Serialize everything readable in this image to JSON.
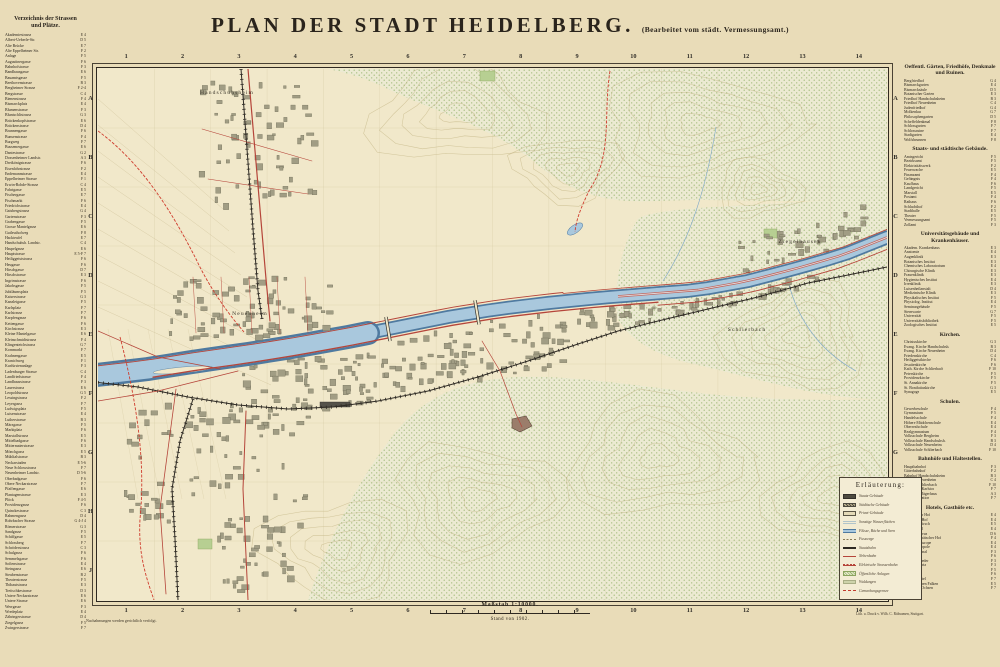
{
  "title": {
    "main": "PLAN DER STADT HEIDELBERG.",
    "sub": "(Bearbeitet vom städt. Vermessungsamt.)"
  },
  "footer": {
    "scale_label": "Maßstab 1:10000.",
    "stand": "Stand von 1902.",
    "note_left": "Nachahmungen werden gerichtlich verfolgt.",
    "note_right": "Lith. u. Druck v. Wilh. C. Rübsamen, Stuttgart."
  },
  "left_index": {
    "heading_line1": "Verzeichnis der Strassen",
    "heading_line2": "und Plätze.",
    "entries": [
      [
        "Akademiestrasse",
        "E 4"
      ],
      [
        "Albert-Ueberle-Str.",
        "D 5"
      ],
      [
        "Alte Brücke",
        "E 7"
      ],
      [
        "Alte Eppelheimer Str.",
        "F 2"
      ],
      [
        "Anlage",
        "F 5"
      ],
      [
        "Augustinergasse",
        "F 6"
      ],
      [
        "Bahnhofstrasse",
        "F 3"
      ],
      [
        "Bandhausgasse",
        "E 6"
      ],
      [
        "Bauamtsgasse",
        "F 5"
      ],
      [
        "Beethovenstrasse",
        "B 3"
      ],
      [
        "Bergheimer Strasse",
        "F 2-4"
      ],
      [
        "Bergstrasse",
        "C 4"
      ],
      [
        "Bienenstrasse",
        "F 4"
      ],
      [
        "Bismarckplatz",
        "E 4"
      ],
      [
        "Blumenstrasse",
        "F 3"
      ],
      [
        "Bluntschlistrasse",
        "G 3"
      ],
      [
        "Brückenkopfstrasse",
        "E 6"
      ],
      [
        "Brückenstrasse",
        "D 4"
      ],
      [
        "Brunnengasse",
        "F 6"
      ],
      [
        "Bunsenstrasse",
        "F 4"
      ],
      [
        "Burgweg",
        "F 7"
      ],
      [
        "Bussemergasse",
        "E 6"
      ],
      [
        "Dantestrasse",
        "G 2"
      ],
      [
        "Dossenheimer Landstr.",
        "A 3"
      ],
      [
        "Dreikönigstrasse",
        "F 6"
      ],
      [
        "Eisenlohrstrasse",
        "F 2"
      ],
      [
        "Endemannstrasse",
        "E 4"
      ],
      [
        "Eppelheimer Strasse",
        "F 1"
      ],
      [
        "Erwin-Rohde-Strasse",
        "C 4"
      ],
      [
        "Fahrtgasse",
        "E 5"
      ],
      [
        "Fischergasse",
        "E 7"
      ],
      [
        "Fischmarkt",
        "F 6"
      ],
      [
        "Friedrichstrasse",
        "E 4"
      ],
      [
        "Gaisbergstrasse",
        "G 4"
      ],
      [
        "Gartenstrasse",
        "F 3"
      ],
      [
        "Grabengasse",
        "F 5"
      ],
      [
        "Grosse Mantelgasse",
        "E 6"
      ],
      [
        "Gutleuthofweg",
        "F 8"
      ],
      [
        "Hackteufel",
        "E 7"
      ],
      [
        "Handschuhsh. Landstr.",
        "C 4"
      ],
      [
        "Haspelgasse",
        "E 6"
      ],
      [
        "Hauptstrasse",
        "E 5-F 7"
      ],
      [
        "Heiliggeiststrasse",
        "F 6"
      ],
      [
        "Heugasse",
        "F 6"
      ],
      [
        "Hirschgasse",
        "D 7"
      ],
      [
        "Hirschstrasse",
        "E 3"
      ],
      [
        "Ingrimstrasse",
        "F 6"
      ],
      [
        "Jakobsgasse",
        "F 5"
      ],
      [
        "Jubiläumsplatz",
        "F 5"
      ],
      [
        "Kaiserstrasse",
        "G 3"
      ],
      [
        "Kanzleigasse",
        "F 5"
      ],
      [
        "Karlsplatz",
        "F 7"
      ],
      [
        "Karlstrasse",
        "F 7"
      ],
      [
        "Karpfengasse",
        "F 6"
      ],
      [
        "Kettengasse",
        "F 6"
      ],
      [
        "Kirchstrasse",
        "E 3"
      ],
      [
        "Kleine Mantelgasse",
        "E 6"
      ],
      [
        "Kleinschmidtstrasse",
        "F 4"
      ],
      [
        "Klingenteichstrasse",
        "G 7"
      ],
      [
        "Kornmarkt",
        "F 7"
      ],
      [
        "Krahnengasse",
        "E 5"
      ],
      [
        "Kranichweg",
        "F 1"
      ],
      [
        "Kurfürstenanlage",
        "F 3"
      ],
      [
        "Ladenburger Strasse",
        "C 4"
      ],
      [
        "Landfriedstrasse",
        "F 4"
      ],
      [
        "Landhausstrasse",
        "F 3"
      ],
      [
        "Lauerstrasse",
        "E 6"
      ],
      [
        "Leopoldstrasse",
        "G 5"
      ],
      [
        "Lessingstrasse",
        "F 2"
      ],
      [
        "Leyergasse",
        "F 7"
      ],
      [
        "Ludwigsplatz",
        "F 5"
      ],
      [
        "Luisenstrasse",
        "E 4"
      ],
      [
        "Lutherstrasse",
        "B 3"
      ],
      [
        "Märzgasse",
        "F 5"
      ],
      [
        "Marktplatz",
        "F 6"
      ],
      [
        "Marstallstrasse",
        "E 5"
      ],
      [
        "Mittelbadgasse",
        "F 6"
      ],
      [
        "Mittermaierstrasse",
        "E 3"
      ],
      [
        "Mönchgasse",
        "E 5"
      ],
      [
        "Mühltalstrasse",
        "B 3"
      ],
      [
        "Neckarstaden",
        "E 5-6"
      ],
      [
        "Neue Schlossstrasse",
        "F 7"
      ],
      [
        "Neuenheimer Landstr.",
        "D 5-6"
      ],
      [
        "Oberbadgasse",
        "F 6"
      ],
      [
        "Obere Neckarstrasse",
        "F 7"
      ],
      [
        "Pfaffengasse",
        "E 6"
      ],
      [
        "Plantagenstrasse",
        "E 3"
      ],
      [
        "Plöck",
        "F 4-5"
      ],
      [
        "Providenzgasse",
        "F 6"
      ],
      [
        "Quinckestrasse",
        "C 3"
      ],
      [
        "Rahmengasse",
        "D 4"
      ],
      [
        "Rohrbacher Strasse",
        "G 4-J 4"
      ],
      [
        "Römerstrasse",
        "G 3"
      ],
      [
        "Sandgasse",
        "F 5"
      ],
      [
        "Schiffgasse",
        "E 5"
      ],
      [
        "Schlossberg",
        "F 7"
      ],
      [
        "Schröderstrasse",
        "C 3"
      ],
      [
        "Schulgasse",
        "F 6"
      ],
      [
        "Semmelsgasse",
        "F 6"
      ],
      [
        "Sofienstrasse",
        "E 4"
      ],
      [
        "Steingasse",
        "E 6"
      ],
      [
        "Steubenstrasse",
        "B 2"
      ],
      [
        "Theaterstrasse",
        "F 5"
      ],
      [
        "Thibautstrasse",
        "E 3"
      ],
      [
        "Treitschkestrasse",
        "D 3"
      ],
      [
        "Untere Neckarstrasse",
        "E 6"
      ],
      [
        "Untere Strasse",
        "E 6"
      ],
      [
        "Werrgasse",
        "F 3"
      ],
      [
        "Wredeplatz",
        "E 4"
      ],
      [
        "Zähringerstrasse",
        "D 4"
      ],
      [
        "Ziegelgasse",
        "F 5"
      ],
      [
        "Zwingerstrasse",
        "F 7"
      ]
    ]
  },
  "right_index": {
    "sections": [
      {
        "heading": "Oeffentl. Gärten, Friedhöfe, Denkmale und Ruinen.",
        "entries": [
          [
            "Bergfriedhof",
            "G 4"
          ],
          [
            "Bismarckgarten",
            "E 4"
          ],
          [
            "Bismarcksäule",
            "D 5"
          ],
          [
            "Botanischer Garten",
            "E 3"
          ],
          [
            "Friedhof Handschuhsheim",
            "B 3"
          ],
          [
            "Friedhof Neuenheim",
            "C 4"
          ],
          [
            "Judenfriedhof",
            "G 4"
          ],
          [
            "Molkenkur",
            "G 7"
          ],
          [
            "Philosophengarten",
            "D 5"
          ],
          [
            "Scheffeldenkmal",
            "F 8"
          ],
          [
            "Schlossgarten",
            "F 7"
          ],
          [
            "Schlossruine",
            "F 7"
          ],
          [
            "Stadtgarten",
            "E 4"
          ],
          [
            "Wolfsbrunnen",
            "F 8"
          ]
        ]
      },
      {
        "heading": "Staats- und städtische Gebäude.",
        "entries": [
          [
            "Amtsgericht",
            "F 5"
          ],
          [
            "Bezirksamt",
            "F 5"
          ],
          [
            "Elektrizitätswerk",
            "F 2"
          ],
          [
            "Feuerwache",
            "E 5"
          ],
          [
            "Finanzamt",
            "F 4"
          ],
          [
            "Gefängnis",
            "F 4"
          ],
          [
            "Kaufhaus",
            "F 6"
          ],
          [
            "Landgericht",
            "F 5"
          ],
          [
            "Marstall",
            "E 5"
          ],
          [
            "Postamt",
            "F 4"
          ],
          [
            "Rathaus",
            "F 6"
          ],
          [
            "Schlachthof",
            "F 2"
          ],
          [
            "Stadthalle",
            "E 5"
          ],
          [
            "Theater",
            "F 5"
          ],
          [
            "Vermessungsamt",
            "F 5"
          ],
          [
            "Zollamt",
            "F 3"
          ]
        ]
      },
      {
        "heading": "Universitätsgebäude und Krankenhäuser.",
        "entries": [
          [
            "Akadem. Krankenhaus",
            "E 3"
          ],
          [
            "Anatomie",
            "E 4"
          ],
          [
            "Augenklinik",
            "E 3"
          ],
          [
            "Botanisches Institut",
            "E 3"
          ],
          [
            "Chemisches Laboratorium",
            "E 4"
          ],
          [
            "Chirurgische Klinik",
            "E 3"
          ],
          [
            "Frauenklinik",
            "E 3"
          ],
          [
            "Hygienisches Institut",
            "E 4"
          ],
          [
            "Irrenklinik",
            "E 3"
          ],
          [
            "Luisenheilanstalt",
            "D 4"
          ],
          [
            "Medizinische Klinik",
            "E 3"
          ],
          [
            "Physikalisches Institut",
            "F 5"
          ],
          [
            "Physiolog. Institut",
            "E 4"
          ],
          [
            "Seminargebäude",
            "F 5"
          ],
          [
            "Sternwarte",
            "G 7"
          ],
          [
            "Universität",
            "F 5"
          ],
          [
            "Universitätsbibliothek",
            "F 5"
          ],
          [
            "Zoologisches Institut",
            "E 5"
          ]
        ]
      },
      {
        "heading": "Kirchen.",
        "entries": [
          [
            "Christuskirche",
            "G 3"
          ],
          [
            "Evang. Kirche Handschuhsh.",
            "B 3"
          ],
          [
            "Evang. Kirche Neuenheim",
            "D 4"
          ],
          [
            "Friedenskirche",
            "C 4"
          ],
          [
            "Heiliggeistkirche",
            "F 6"
          ],
          [
            "Jesuitenkirche",
            "F 6"
          ],
          [
            "Kath. Kirche Schlierbach",
            "F 10"
          ],
          [
            "Peterskirche",
            "F 5"
          ],
          [
            "Providenzkirche",
            "F 5"
          ],
          [
            "St. Annakirche",
            "F 5"
          ],
          [
            "St. Bonifatiuskirche",
            "G 3"
          ],
          [
            "Synagoge",
            "E 5"
          ]
        ]
      },
      {
        "heading": "Schulen.",
        "entries": [
          [
            "Gewerbeschule",
            "F 4"
          ],
          [
            "Gymnasium",
            "F 5"
          ],
          [
            "Handelsschule",
            "F 4"
          ],
          [
            "Höhere Mädchenschule",
            "E 4"
          ],
          [
            "Oberrealschule",
            "E 4"
          ],
          [
            "Realgymnasium",
            "F 4"
          ],
          [
            "Volksschule Bergheim",
            "F 3"
          ],
          [
            "Volksschule Handschuhsh.",
            "B 3"
          ],
          [
            "Volksschule Neuenheim",
            "D 4"
          ],
          [
            "Volksschule Schlierbach",
            "F 10"
          ]
        ]
      },
      {
        "heading": "Bahnhöfe und Haltestellen.",
        "entries": [
          [
            "Hauptbahnhof",
            "F 3"
          ],
          [
            "Güterbahnhof",
            "F 2"
          ],
          [
            "Bahnhof Handschuhsheim",
            "B 3"
          ],
          [
            "Bahnhof Neuenheim",
            "C 4"
          ],
          [
            "Bahnhof Schlierbach",
            "F 10"
          ],
          [
            "Haltestelle Karlstor",
            "F 7"
          ],
          [
            "Haltestelle Jägerhaus",
            "A 3"
          ],
          [
            "Bergbahnstation",
            "F 7"
          ]
        ]
      },
      {
        "heading": "Hotels, Gasthöfe etc.",
        "entries": [
          [
            "Darmstädter Hof",
            "E 4"
          ],
          [
            "Englischer Hof",
            "E 4"
          ],
          [
            "Goldener Hirsch",
            "E 5"
          ],
          [
            "Grand Hotel",
            "E 4"
          ],
          [
            "Hotel Bellevue",
            "D 6"
          ],
          [
            "Hotel Europäischer Hof",
            "F 4"
          ],
          [
            "Hotel de l'Europe",
            "E 4"
          ],
          [
            "Hotel Metropole",
            "E 4"
          ],
          [
            "Hotel National",
            "F 3"
          ],
          [
            "Hotel Ritter",
            "F 6"
          ],
          [
            "Hotel Schrieder",
            "F 3"
          ],
          [
            "Hotel Victoria",
            "F 3"
          ],
          [
            "Kaiserhof",
            "F 5"
          ],
          [
            "Prinz Carl",
            "F 6"
          ],
          [
            "Schloss-Hotel",
            "F 7"
          ],
          [
            "Zum goldenen Falken",
            "E 5"
          ],
          [
            "Zum roten Ochsen",
            "F 7"
          ]
        ]
      }
    ]
  },
  "map": {
    "grid_cols": [
      "1",
      "2",
      "3",
      "4",
      "5",
      "6",
      "7",
      "8",
      "9",
      "10",
      "11",
      "12",
      "13",
      "14"
    ],
    "grid_rows": [
      "A",
      "B",
      "C",
      "D",
      "E",
      "F",
      "G",
      "H",
      "J"
    ],
    "labels": [
      {
        "text": "Handschuhsheim",
        "x": 129,
        "y": 25
      },
      {
        "text": "Neuenheim",
        "x": 152,
        "y": 246
      },
      {
        "text": "Ziegelhausen",
        "x": 702,
        "y": 174
      },
      {
        "text": "Schlierbach",
        "x": 649,
        "y": 262
      }
    ],
    "legend": {
      "title": "Erläuterung:",
      "items": [
        {
          "swatch": "state",
          "label": "Staats-Gebäude"
        },
        {
          "swatch": "city",
          "label": "Städtische Gebäude"
        },
        {
          "swatch": "priv",
          "label": "Privat-Gebäude"
        },
        {
          "swatch": "water2",
          "label": "Sonstige Wasserflächen"
        },
        {
          "swatch": "river",
          "label": "Flüsse, Bäche und Seen"
        },
        {
          "swatch": "path",
          "label": "Fusswege"
        },
        {
          "swatch": "bahn",
          "label": "Staatsbahn"
        },
        {
          "swatch": "neben",
          "label": "Nebenbahn"
        },
        {
          "swatch": "tram",
          "label": "Elektrische Strassenbahn"
        },
        {
          "swatch": "anlage",
          "label": "Öffentliche Anlagen"
        },
        {
          "swatch": "wald",
          "label": "Waldungen"
        },
        {
          "swatch": "grenze",
          "label": "Gemarkungsgrenze"
        }
      ]
    }
  },
  "colors": {
    "paper": "#e9dcb8",
    "map_bg": "#f1e8ca",
    "river_light": "#a9c8dd",
    "river_dark": "#4f7aa0",
    "red_channel": "#c4574a",
    "road": "#b5453a",
    "boundary": "#cf3d2e",
    "rail": "#2e2a24",
    "building": "#a19d84",
    "building_edge": "#6e6b56",
    "forest_fill": "#ecead2",
    "forest_dot": "#93b26a",
    "contour": "#b3a36b",
    "field_line": "#c6b88c",
    "grid_line": "#c9bc93",
    "park": "#b7cf92",
    "ink": "#2a241c"
  }
}
